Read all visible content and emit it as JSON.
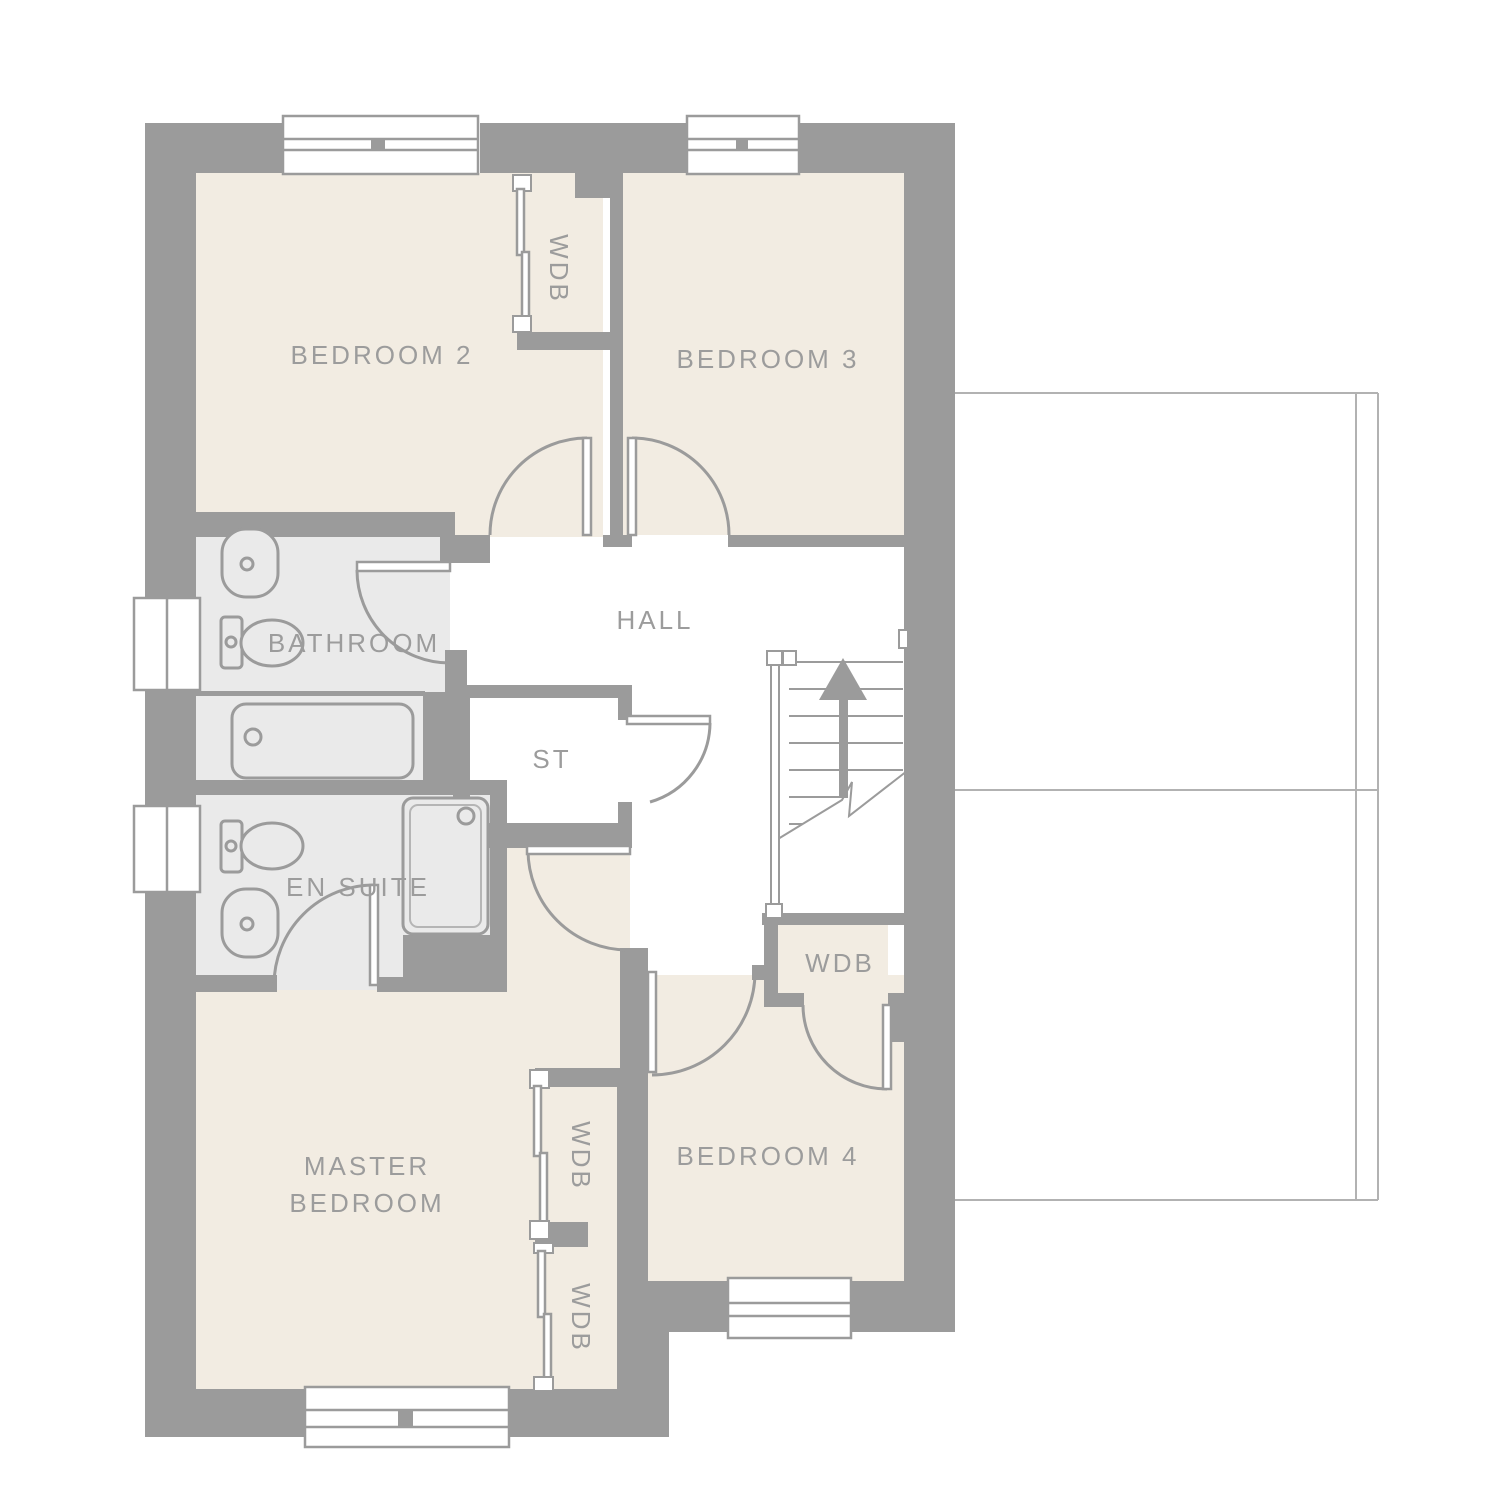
{
  "labels": {
    "bedroom2": "BEDROOM 2",
    "bedroom3": "BEDROOM 3",
    "bedroom4": "BEDROOM 4",
    "master_line1": "MASTER",
    "master_line2": "BEDROOM",
    "bathroom": "BATHROOM",
    "en_suite": "EN SUITE",
    "hall": "HALL",
    "store": "ST",
    "wdb": "WDB"
  },
  "colors": {
    "wall": "#9b9b9b",
    "cream": "#f2ece2",
    "groom": "#eaeaea",
    "text": "#9c9c9c",
    "thin": "#b2b2b2"
  },
  "icons": {
    "stairs_direction": "up-arrow"
  }
}
